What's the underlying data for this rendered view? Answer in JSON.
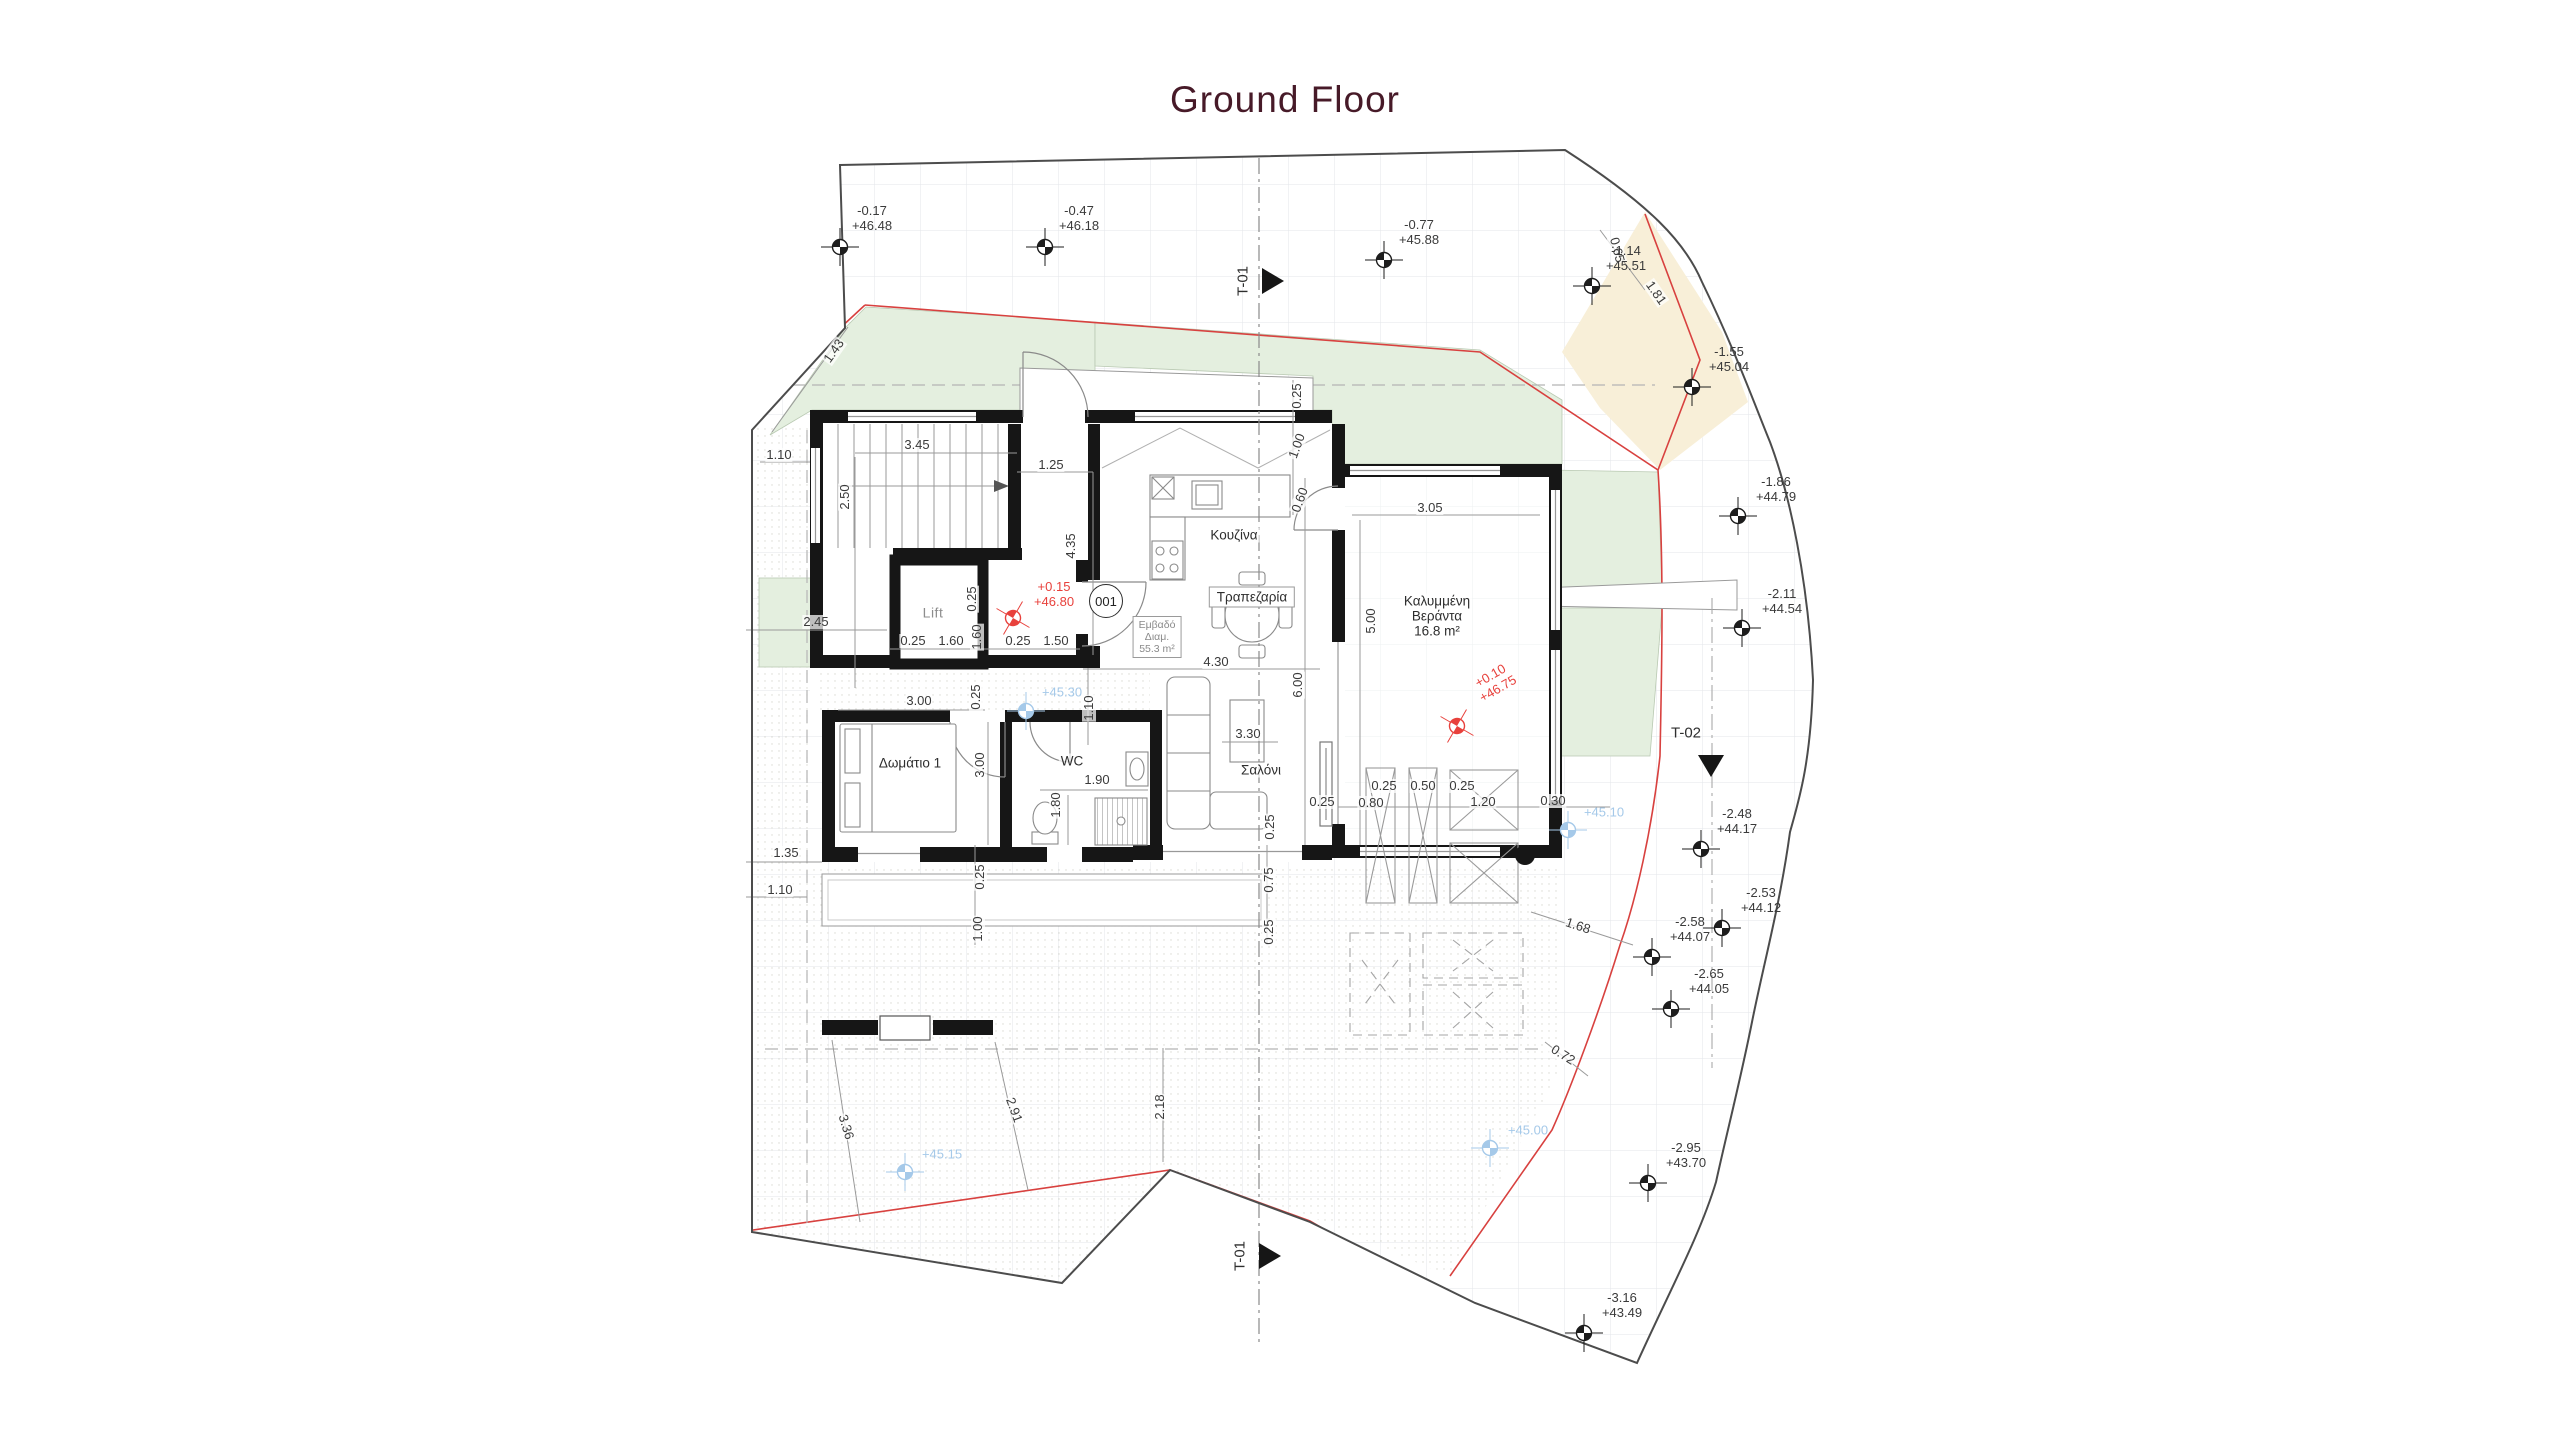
{
  "title": "Ground Floor",
  "colors": {
    "title": "#471a28",
    "red_boundary": "#d8413f",
    "red_level": "#e8413c",
    "blue_level": "#a5c9e9",
    "green_fill": "#e4efdf",
    "cream_fill": "#f8efd8",
    "grid": "#e3e6ea",
    "wall": "#161616",
    "dim_text": "#3a3a3a"
  },
  "rooms": [
    {
      "id": "lift",
      "lines": [
        "Lift"
      ],
      "x": 933,
      "y": 613,
      "gray": true
    },
    {
      "id": "kitchen",
      "lines": [
        "Κουζίνα"
      ],
      "x": 1234,
      "y": 535
    },
    {
      "id": "dining",
      "lines": [
        "Τραπεζαρία"
      ],
      "x": 1252,
      "y": 597,
      "boxed": true
    },
    {
      "id": "apartment-area",
      "lines": [
        "Εμβαδό",
        "Διαμ.",
        "55.3 m²"
      ],
      "x": 1157,
      "y": 637,
      "boxed": true,
      "small": true
    },
    {
      "id": "living",
      "lines": [
        "Σαλόνι"
      ],
      "x": 1261,
      "y": 770
    },
    {
      "id": "bedroom-1",
      "lines": [
        "Δωμάτιο 1"
      ],
      "x": 910,
      "y": 763
    },
    {
      "id": "wc",
      "lines": [
        "WC"
      ],
      "x": 1072,
      "y": 761
    },
    {
      "id": "covered-veranda",
      "lines": [
        "Καλυμμένη",
        "Βεράντα",
        "16.8 m²"
      ],
      "x": 1437,
      "y": 616
    }
  ],
  "door_tag": {
    "label": "001",
    "x": 1106,
    "y": 601
  },
  "dimensions": [
    {
      "t": "3.45",
      "x": 917,
      "y": 445,
      "r": 0
    },
    {
      "t": "2.50",
      "x": 845,
      "y": 497,
      "r": -90
    },
    {
      "t": "1.25",
      "x": 1051,
      "y": 465,
      "r": 0
    },
    {
      "t": "4.35",
      "x": 1071,
      "y": 546,
      "r": -90
    },
    {
      "t": "1.10",
      "x": 779,
      "y": 455,
      "r": 0
    },
    {
      "t": "1.43",
      "x": 834,
      "y": 351,
      "r": -55
    },
    {
      "t": "2.45",
      "x": 816,
      "y": 622,
      "r": 0
    },
    {
      "t": "0.25",
      "x": 972,
      "y": 599,
      "r": -90
    },
    {
      "t": "0.25",
      "x": 913,
      "y": 641,
      "r": 0
    },
    {
      "t": "1.60",
      "x": 951,
      "y": 641,
      "r": 0
    },
    {
      "t": "1.60",
      "x": 977,
      "y": 637,
      "r": -90
    },
    {
      "t": "0.25",
      "x": 1018,
      "y": 641,
      "r": 0
    },
    {
      "t": "1.50",
      "x": 1056,
      "y": 641,
      "r": 0
    },
    {
      "t": "3.00",
      "x": 919,
      "y": 701,
      "r": 0
    },
    {
      "t": "0.25",
      "x": 976,
      "y": 697,
      "r": -90
    },
    {
      "t": "1.10",
      "x": 1089,
      "y": 708,
      "r": -90
    },
    {
      "t": "3.00",
      "x": 980,
      "y": 765,
      "r": -90
    },
    {
      "t": "1.90",
      "x": 1097,
      "y": 780,
      "r": 0
    },
    {
      "t": "1.80",
      "x": 1056,
      "y": 805,
      "r": -90
    },
    {
      "t": "0.25",
      "x": 980,
      "y": 877,
      "r": -90
    },
    {
      "t": "1.00",
      "x": 978,
      "y": 929,
      "r": -90
    },
    {
      "t": "1.35",
      "x": 786,
      "y": 853,
      "r": 0
    },
    {
      "t": "1.10",
      "x": 780,
      "y": 890,
      "r": 0
    },
    {
      "t": "0.25",
      "x": 1297,
      "y": 396,
      "r": -90
    },
    {
      "t": "1.00",
      "x": 1297,
      "y": 446,
      "r": -70
    },
    {
      "t": "0.60",
      "x": 1300,
      "y": 500,
      "r": -70
    },
    {
      "t": "3.05",
      "x": 1430,
      "y": 508,
      "r": 0
    },
    {
      "t": "5.00",
      "x": 1371,
      "y": 621,
      "r": -90
    },
    {
      "t": "4.30",
      "x": 1216,
      "y": 662,
      "r": 0
    },
    {
      "t": "6.00",
      "x": 1298,
      "y": 685,
      "r": -90
    },
    {
      "t": "3.30",
      "x": 1248,
      "y": 734,
      "r": 0
    },
    {
      "t": "0.25",
      "x": 1322,
      "y": 802,
      "r": 0
    },
    {
      "t": "0.80",
      "x": 1371,
      "y": 803,
      "r": 0
    },
    {
      "t": "0.25",
      "x": 1384,
      "y": 786,
      "r": 0
    },
    {
      "t": "0.50",
      "x": 1423,
      "y": 786,
      "r": 0
    },
    {
      "t": "0.25",
      "x": 1462,
      "y": 786,
      "r": 0
    },
    {
      "t": "1.20",
      "x": 1483,
      "y": 802,
      "r": 0
    },
    {
      "t": "0.30",
      "x": 1553,
      "y": 801,
      "r": 0
    },
    {
      "t": "0.25",
      "x": 1270,
      "y": 827,
      "r": -90
    },
    {
      "t": "0.75",
      "x": 1269,
      "y": 880,
      "r": -90
    },
    {
      "t": "0.25",
      "x": 1269,
      "y": 932,
      "r": -90
    },
    {
      "t": "1.68",
      "x": 1578,
      "y": 926,
      "r": 18
    },
    {
      "t": "0.72",
      "x": 1563,
      "y": 1055,
      "r": 32
    },
    {
      "t": "3.36",
      "x": 846,
      "y": 1127,
      "r": 73
    },
    {
      "t": "2.91",
      "x": 1014,
      "y": 1110,
      "r": 70
    },
    {
      "t": "2.18",
      "x": 1160,
      "y": 1107,
      "r": -90
    },
    {
      "t": "1.81",
      "x": 1656,
      "y": 293,
      "r": 55
    },
    {
      "t": "0.65",
      "x": 1617,
      "y": 250,
      "r": 75
    }
  ],
  "survey_points": [
    {
      "x": 840,
      "y": 247,
      "tx": 872,
      "ty": 218,
      "offset": "-0.17",
      "elevation": "+46.48"
    },
    {
      "x": 1045,
      "y": 247,
      "tx": 1079,
      "ty": 218,
      "offset": "-0.47",
      "elevation": "+46.18"
    },
    {
      "x": 1384,
      "y": 260,
      "tx": 1419,
      "ty": 232,
      "offset": "-0.77",
      "elevation": "+45.88"
    },
    {
      "x": 1592,
      "y": 286,
      "tx": 1626,
      "ty": 258,
      "offset": "-1.14",
      "elevation": "+45.51"
    },
    {
      "x": 1692,
      "y": 387,
      "tx": 1729,
      "ty": 359,
      "offset": "-1.55",
      "elevation": "+45.04"
    },
    {
      "x": 1738,
      "y": 516,
      "tx": 1776,
      "ty": 489,
      "offset": "-1.86",
      "elevation": "+44.79"
    },
    {
      "x": 1742,
      "y": 628,
      "tx": 1782,
      "ty": 601,
      "offset": "-2.11",
      "elevation": "+44.54"
    },
    {
      "x": 1701,
      "y": 849,
      "tx": 1737,
      "ty": 821,
      "offset": "-2.48",
      "elevation": "+44.17"
    },
    {
      "x": 1722,
      "y": 928,
      "tx": 1761,
      "ty": 900,
      "offset": "-2.53",
      "elevation": "+44.12"
    },
    {
      "x": 1652,
      "y": 957,
      "tx": 1690,
      "ty": 929,
      "offset": "-2.58",
      "elevation": "+44.07"
    },
    {
      "x": 1671,
      "y": 1009,
      "tx": 1709,
      "ty": 981,
      "offset": "-2.65",
      "elevation": "+44.05"
    },
    {
      "x": 1648,
      "y": 1183,
      "tx": 1686,
      "ty": 1155,
      "offset": "-2.95",
      "elevation": "+43.70"
    },
    {
      "x": 1584,
      "y": 1333,
      "tx": 1622,
      "ty": 1305,
      "offset": "-3.16",
      "elevation": "+43.49"
    }
  ],
  "level_points_blue": [
    {
      "x": 1026,
      "y": 711,
      "tx": 1062,
      "ty": 692,
      "label": "+45.30"
    },
    {
      "x": 1568,
      "y": 830,
      "tx": 1604,
      "ty": 812,
      "label": "+45.10"
    },
    {
      "x": 905,
      "y": 1172,
      "tx": 942,
      "ty": 1154,
      "label": "+45.15"
    },
    {
      "x": 1490,
      "y": 1148,
      "tx": 1528,
      "ty": 1130,
      "label": "+45.00"
    }
  ],
  "level_points_red": [
    {
      "x": 1013,
      "y": 618,
      "tx": 1054,
      "ty": 594,
      "lines": [
        "+0.15",
        "+46.80"
      ],
      "rot": 0
    },
    {
      "x": 1457,
      "y": 726,
      "tx": 1494,
      "ty": 682,
      "lines": [
        "+0.10",
        "+46.75"
      ],
      "rot": -30
    }
  ],
  "sections": [
    {
      "label": "T-01",
      "x": 1243,
      "y": 281,
      "rot": -90,
      "tri": "right",
      "tx": 1273,
      "ty": 281
    },
    {
      "label": "T-01",
      "x": 1240,
      "y": 1256,
      "rot": -90,
      "tri": "right",
      "tx": 1270,
      "ty": 1256
    },
    {
      "label": "T-02",
      "x": 1686,
      "y": 733,
      "rot": 0,
      "tri": "down",
      "tx": 1711,
      "ty": 766
    }
  ]
}
